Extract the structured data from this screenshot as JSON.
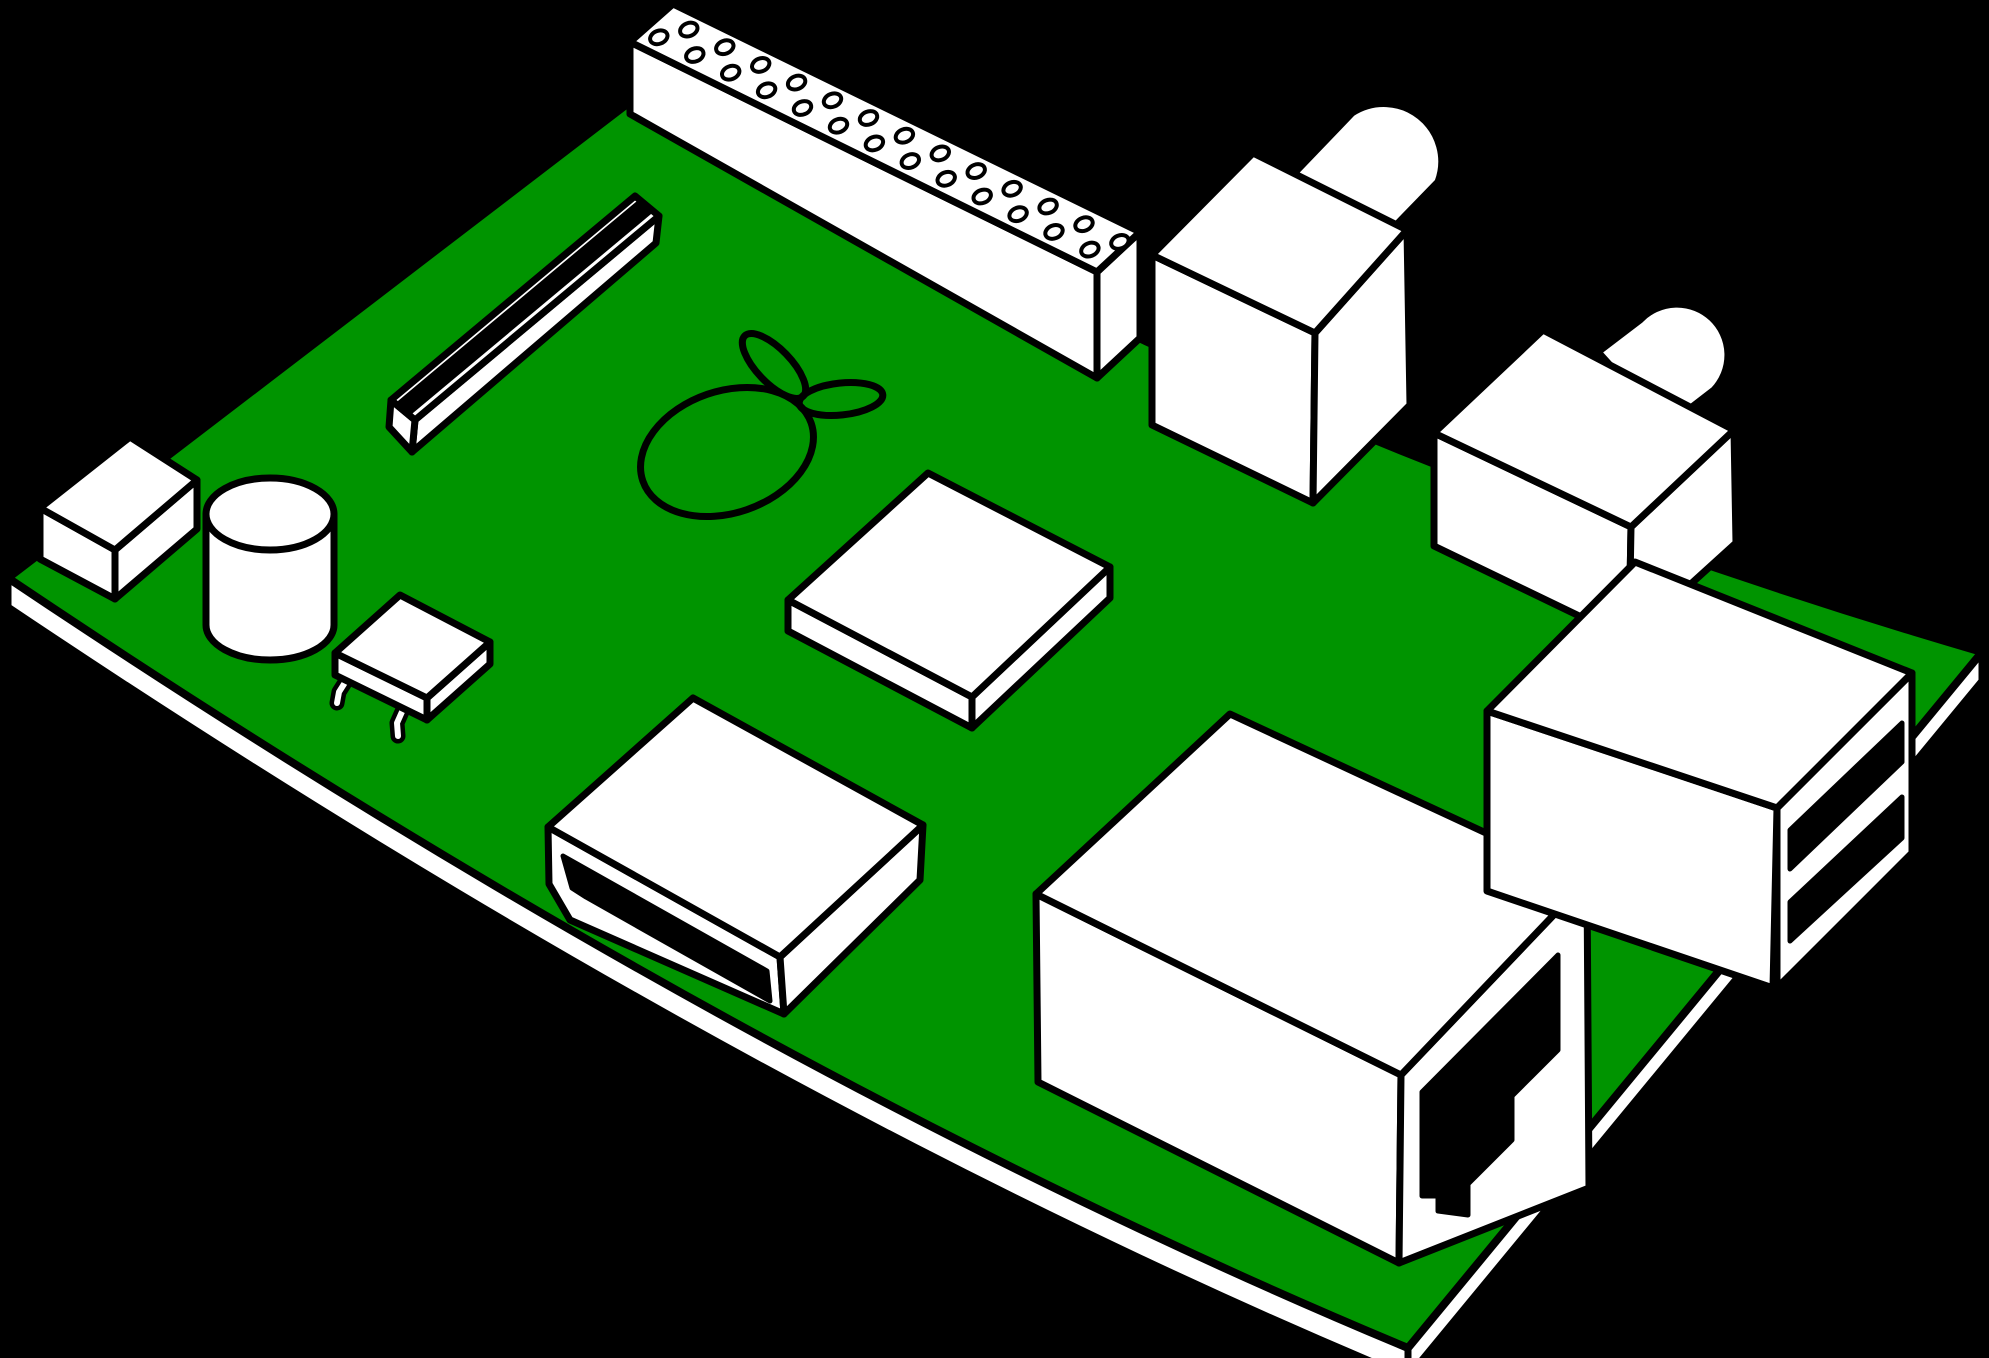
{
  "scene": {
    "description": "Isometric clipart illustration of a Raspberry Pi single-board computer on a black background",
    "background_color": "#000000"
  },
  "colors": {
    "pcb_green": "#009400",
    "component_white": "#ffffff",
    "outline_black": "#000000"
  },
  "components": {
    "board": "green PCB board",
    "board_edge": "PCB side edge",
    "logo": "raspberry outline logo with two leaves",
    "gpio_header": "GPIO pin header with two rows of holes",
    "display_connector": "flat ribbon connector with dark stripe",
    "small_component": "small rectangular component",
    "capacitor": "cylindrical capacitor",
    "leaded_chip": "flat chip with two bent leads",
    "soc_chip": "flat square system-on-chip",
    "rca_video": "RCA video connector with round barrel",
    "audio_jack": "audio jack connector with round barrel",
    "hdmi_port": "HDMI port with dark slot",
    "ethernet_port": "Ethernet port with RJ45 cutout",
    "usb_ports": "dual stacked USB ports with two dark slots"
  },
  "gpio_header": {
    "pin_pairs": 13,
    "rows": 2
  }
}
